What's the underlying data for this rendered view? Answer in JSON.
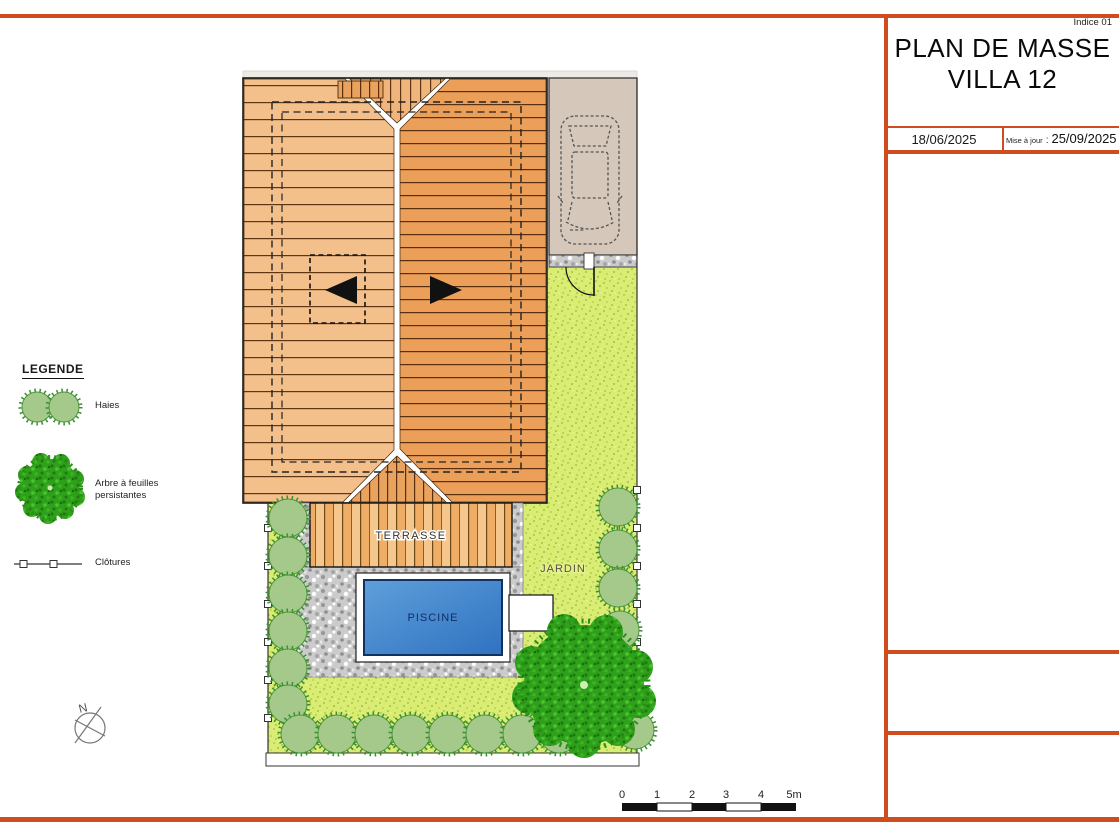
{
  "title_block": {
    "indice": "Indice 01",
    "title_line1": "PLAN DE MASSE",
    "title_line2": "VILLA 12",
    "date_created": "18/06/2025",
    "updated_label": "Mise à jour",
    "updated_colon": ":",
    "date_updated": "25/09/2025"
  },
  "legend": {
    "heading": "LEGENDE",
    "items": [
      {
        "id": "haies",
        "label": "Haies"
      },
      {
        "id": "arbre",
        "label": "Arbre à feuilles persistantes"
      },
      {
        "id": "clotures",
        "label": "Clôtures"
      }
    ]
  },
  "plan": {
    "terrace_label": "TERRASSE",
    "pool_label": "PISCINE",
    "garden_label": "JARDIN",
    "north_label": "N",
    "scale_ticks": [
      "0",
      "1",
      "2",
      "3",
      "4",
      "5m"
    ]
  },
  "colors": {
    "frame_orange": "#cf4c1f",
    "roof_left": "#f3c08c",
    "roof_right": "#ec9f58",
    "garden_green": "#d9ec74",
    "pool_blue": "#4187cd",
    "driveway_beige": "#d5c8ba",
    "gravel_gray": "#cbcbcb",
    "hedge_green": "#a5c98b",
    "tree_green": "#2fa01b"
  }
}
